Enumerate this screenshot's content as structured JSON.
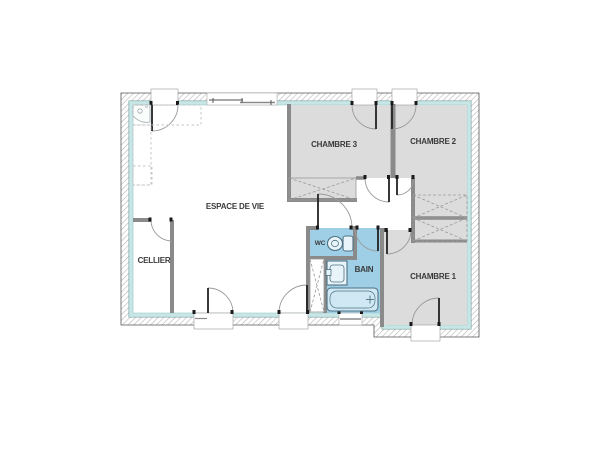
{
  "plan": {
    "name": "house-floor-plan",
    "rooms": [
      {
        "id": "espace-de-vie",
        "label": "ESPACE DE VIE",
        "type": "living-room",
        "fill": "#ffffff"
      },
      {
        "id": "cellier",
        "label": "CELLIER",
        "type": "storage",
        "fill": "#ffffff"
      },
      {
        "id": "chambre-3",
        "label": "CHAMBRE 3",
        "type": "bedroom",
        "fill": "#dcdcdc"
      },
      {
        "id": "chambre-2",
        "label": "CHAMBRE 2",
        "type": "bedroom",
        "fill": "#dcdcdc"
      },
      {
        "id": "chambre-1",
        "label": "CHAMBRE 1",
        "type": "bedroom",
        "fill": "#dcdcdc"
      },
      {
        "id": "wc",
        "label": "WC",
        "type": "toilet",
        "fill": "#9fcfe6"
      },
      {
        "id": "bain",
        "label": "BAIN",
        "type": "bathroom",
        "fill": "#9fcfe6"
      }
    ],
    "fixtures": [
      "toilet",
      "washbasin",
      "bathroom-sink",
      "bathtub",
      "kitchen-counter-dashed"
    ],
    "features": [
      "door-swings",
      "windows",
      "closets-with-cross",
      "hatched-exterior-walls",
      "teal-insulation-band"
    ],
    "colors": {
      "bedroom_gray": "#dcdcdc",
      "wet_room_blue": "#9fcfe6",
      "insulation_teal": "#c9e6e6",
      "interior_wall_gray": "#8a8a8a",
      "hatch_line_gray": "#b0b0b0",
      "label_text": "#3a3a3a"
    }
  }
}
